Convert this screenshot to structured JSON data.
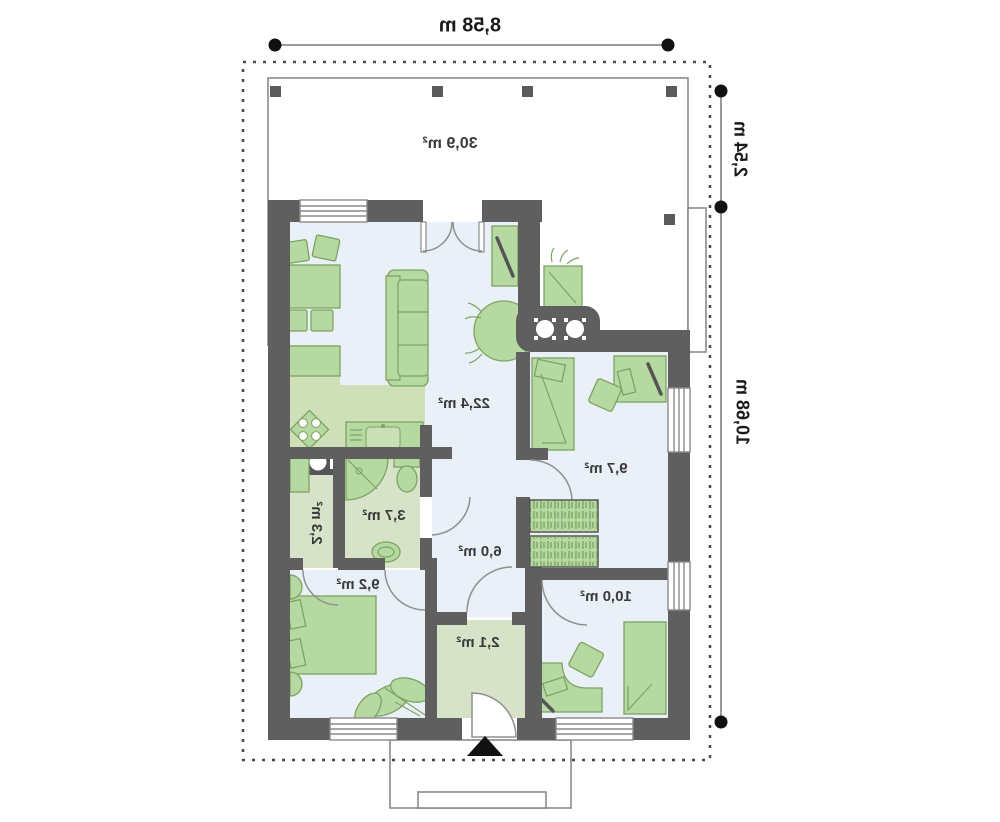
{
  "plan": {
    "dimensions": {
      "width_top": "8,58 m",
      "depth_upper_right": "2,54 m",
      "depth_lower_right": "10,68 m"
    },
    "room_areas": {
      "terrace": "30,9 m²",
      "living_kitchen": "22,4 m²",
      "bedroom_upper_right": "9,7 m²",
      "bathroom": "3,7 m²",
      "storage_wc": "2,3 m²",
      "hall": "6,0 m²",
      "bedroom_left": "9,2 m²",
      "bedroom_lower_right": "10,0 m²",
      "entry_vestibule": "2,1 m²"
    },
    "text_style": "mirrored"
  },
  "colors": {
    "wall": "#5f5f5f",
    "floor": "#eaf0f7",
    "wet_floor": "#d7e3c8",
    "kitchen_floor": "#cfe0b8",
    "furniture": "#b6d9a1",
    "furniture_stroke": "#7da363",
    "door_arc": "#909090",
    "thin_line": "#8a8a8a",
    "dashed": "#4a4a4a",
    "dim_line": "#9a9a9a",
    "dim_dot": "#111111",
    "label": "#3a3a3a"
  }
}
